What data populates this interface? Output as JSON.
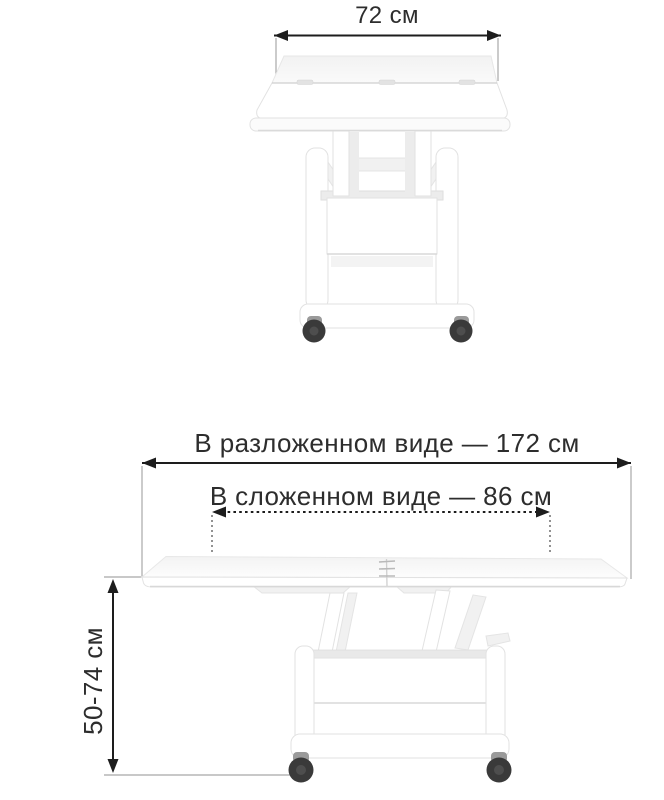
{
  "front_view": {
    "width_label": "72 см"
  },
  "side_view": {
    "unfolded_width_label": "В разложенном виде — 172 см",
    "folded_width_label": "В сложенном виде — 86 см",
    "height_label": "50-74 см"
  },
  "colors": {
    "background": "#ffffff",
    "dimension_line": "#1d1d1d",
    "extension_line": "#a8a8a8",
    "label_text": "#2d2d2d",
    "table_outline": "#e2e2e2",
    "caster_wheel": "#3a3a3a",
    "caster_hub": "#4e4e4e",
    "caster_bracket": "#9a9a9a"
  }
}
